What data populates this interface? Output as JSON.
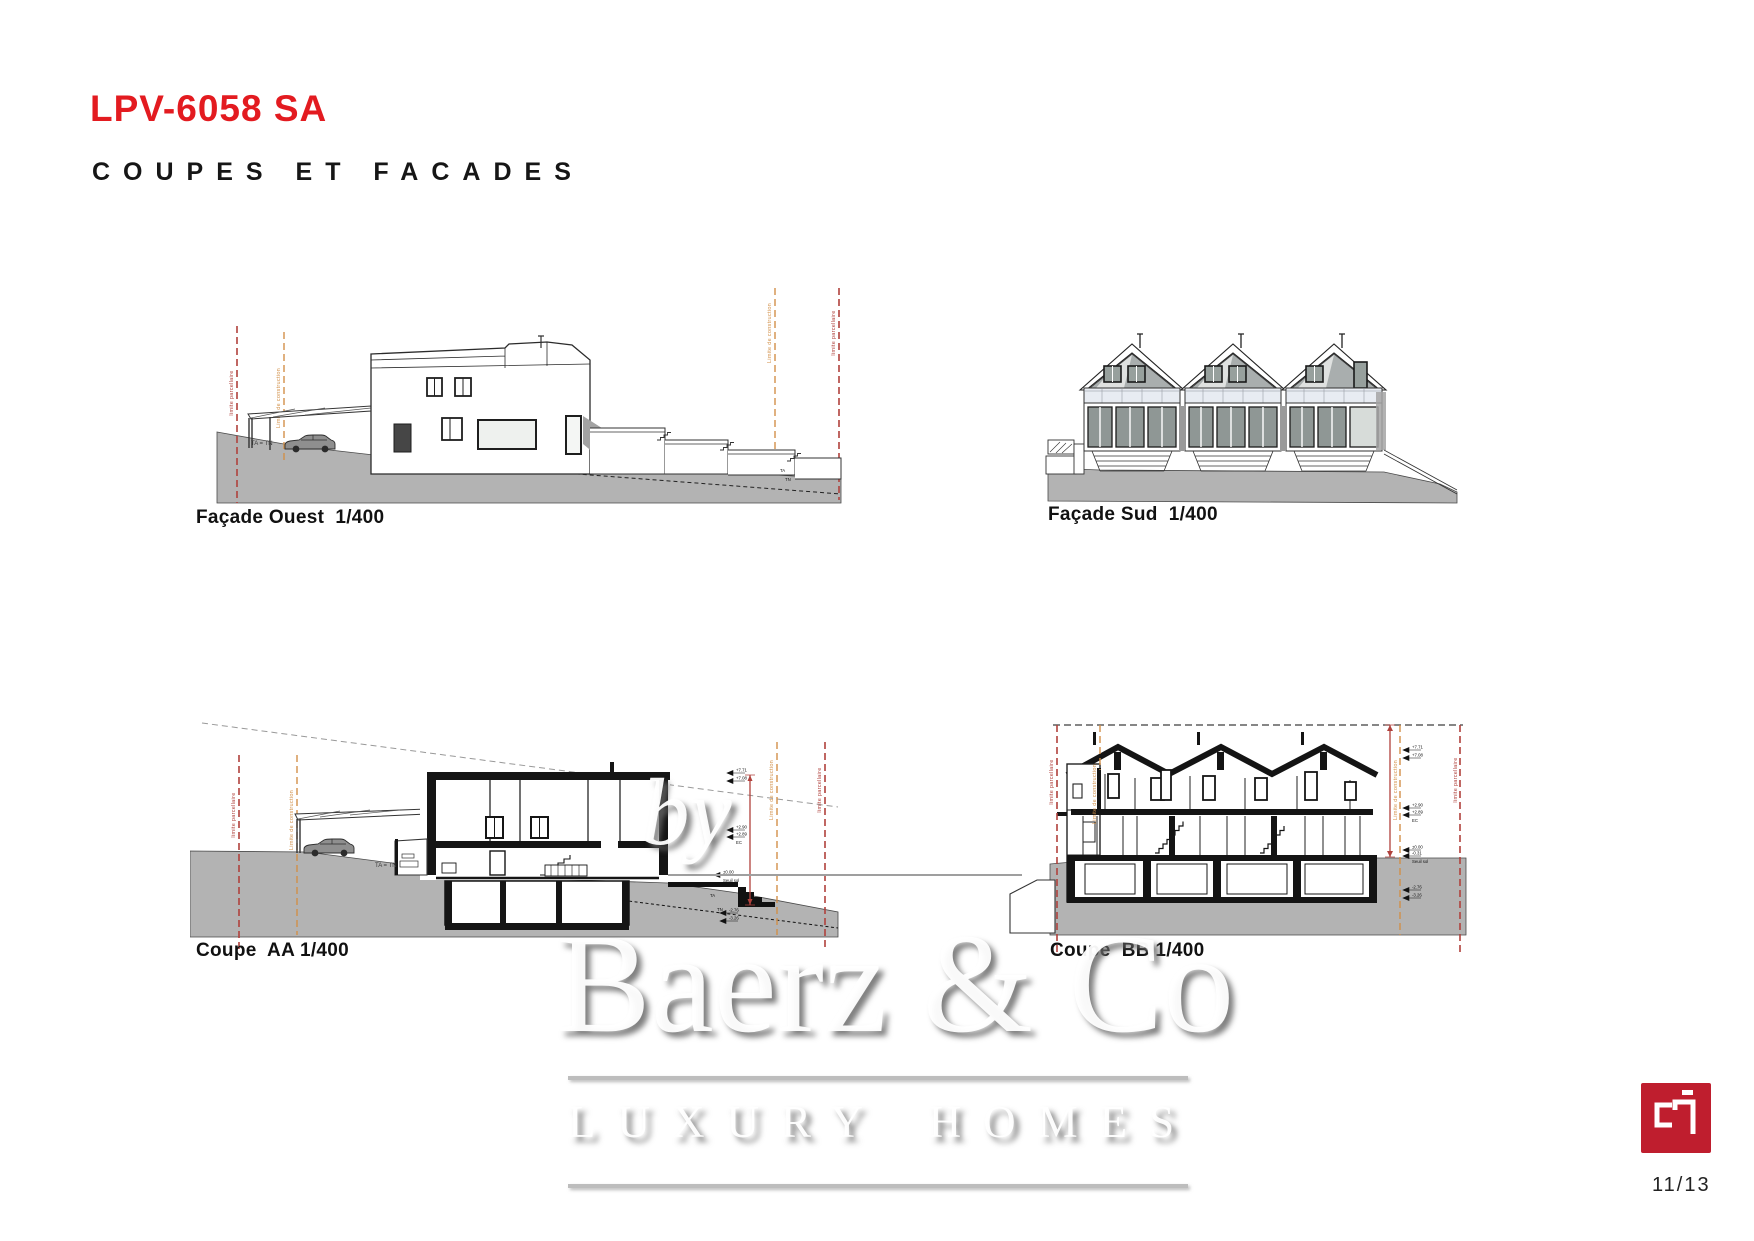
{
  "header": {
    "title": "LPV-6058 SA",
    "subtitle": "COUPES ET FACADES"
  },
  "drawings": {
    "facade_ouest": {
      "caption": "Façade Ouest  1/400"
    },
    "facade_sud": {
      "caption": "Façade Sud  1/400"
    },
    "coupe_aa": {
      "caption": "Coupe  AA 1/400"
    },
    "coupe_bb": {
      "caption": "Coupe  BB 1/400"
    }
  },
  "annotations": {
    "limite_parcellaire": "limite parcellaire",
    "limite_construction": "Limite de construction",
    "terrain_equal": "TA = TN",
    "ta": "TA",
    "tn": "TN",
    "elevations": {
      "v771": "+7.71",
      "v708": "+7.08",
      "v290": "+2.90",
      "v289": "+2.89",
      "ec": "EC",
      "v000": "±0.00",
      "v031": "-0.31",
      "seuil": "Seuil sol",
      "m276": "-2.76",
      "m326": "-3.26"
    }
  },
  "watermark": {
    "by": "by",
    "brand": "Baerz & Co",
    "tagline": "LUXURY HOMES"
  },
  "footer": {
    "page_number": "11/13"
  },
  "colors": {
    "accent_red": "#e31b20",
    "logo_red": "#bf1e2e",
    "limit_red": "#b0413c",
    "limit_orange": "#d29049",
    "terrain_gray": "#b3b3b3"
  }
}
